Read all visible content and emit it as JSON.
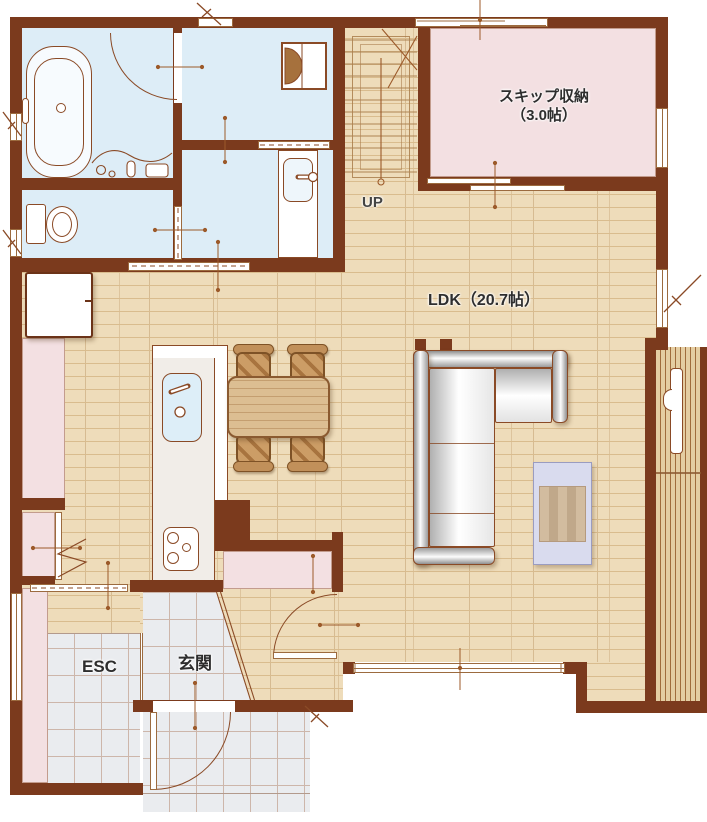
{
  "title": "1F間取り図",
  "labels": {
    "skip_line1": "スキップ収納",
    "skip_line2": "（3.0帖）",
    "ldk": "LDK（20.7帖）",
    "up": "UP",
    "esc": "ESC",
    "genkan": "玄関"
  },
  "rooms": [
    {
      "name": "skip-storage",
      "label": "スキップ収納（3.0帖）"
    },
    {
      "name": "ldk",
      "label": "LDK（20.7帖）"
    },
    {
      "name": "stairs",
      "label": "UP"
    },
    {
      "name": "entrance-storage",
      "label": "ESC"
    },
    {
      "name": "entrance",
      "label": "玄関"
    }
  ],
  "colors": {
    "wall": "#7b3a1d",
    "wood_base": "#eedcba",
    "wood_line": "#d9bc8e",
    "water_room": "#ddedf7",
    "storage_pink": "#f3e0e2",
    "tile": "#eaecef",
    "tile_line": "#cdb6aa",
    "deck_base": "#e4cda2",
    "deck_line": "#a06c3c",
    "outline": "#8a4a26",
    "label_text": "#2e2e2e",
    "table_wood": "#dcbe92",
    "chair_wood": "#c1905a",
    "rug": "#d9dbee",
    "mat_stripe": "#d2bc9f"
  }
}
